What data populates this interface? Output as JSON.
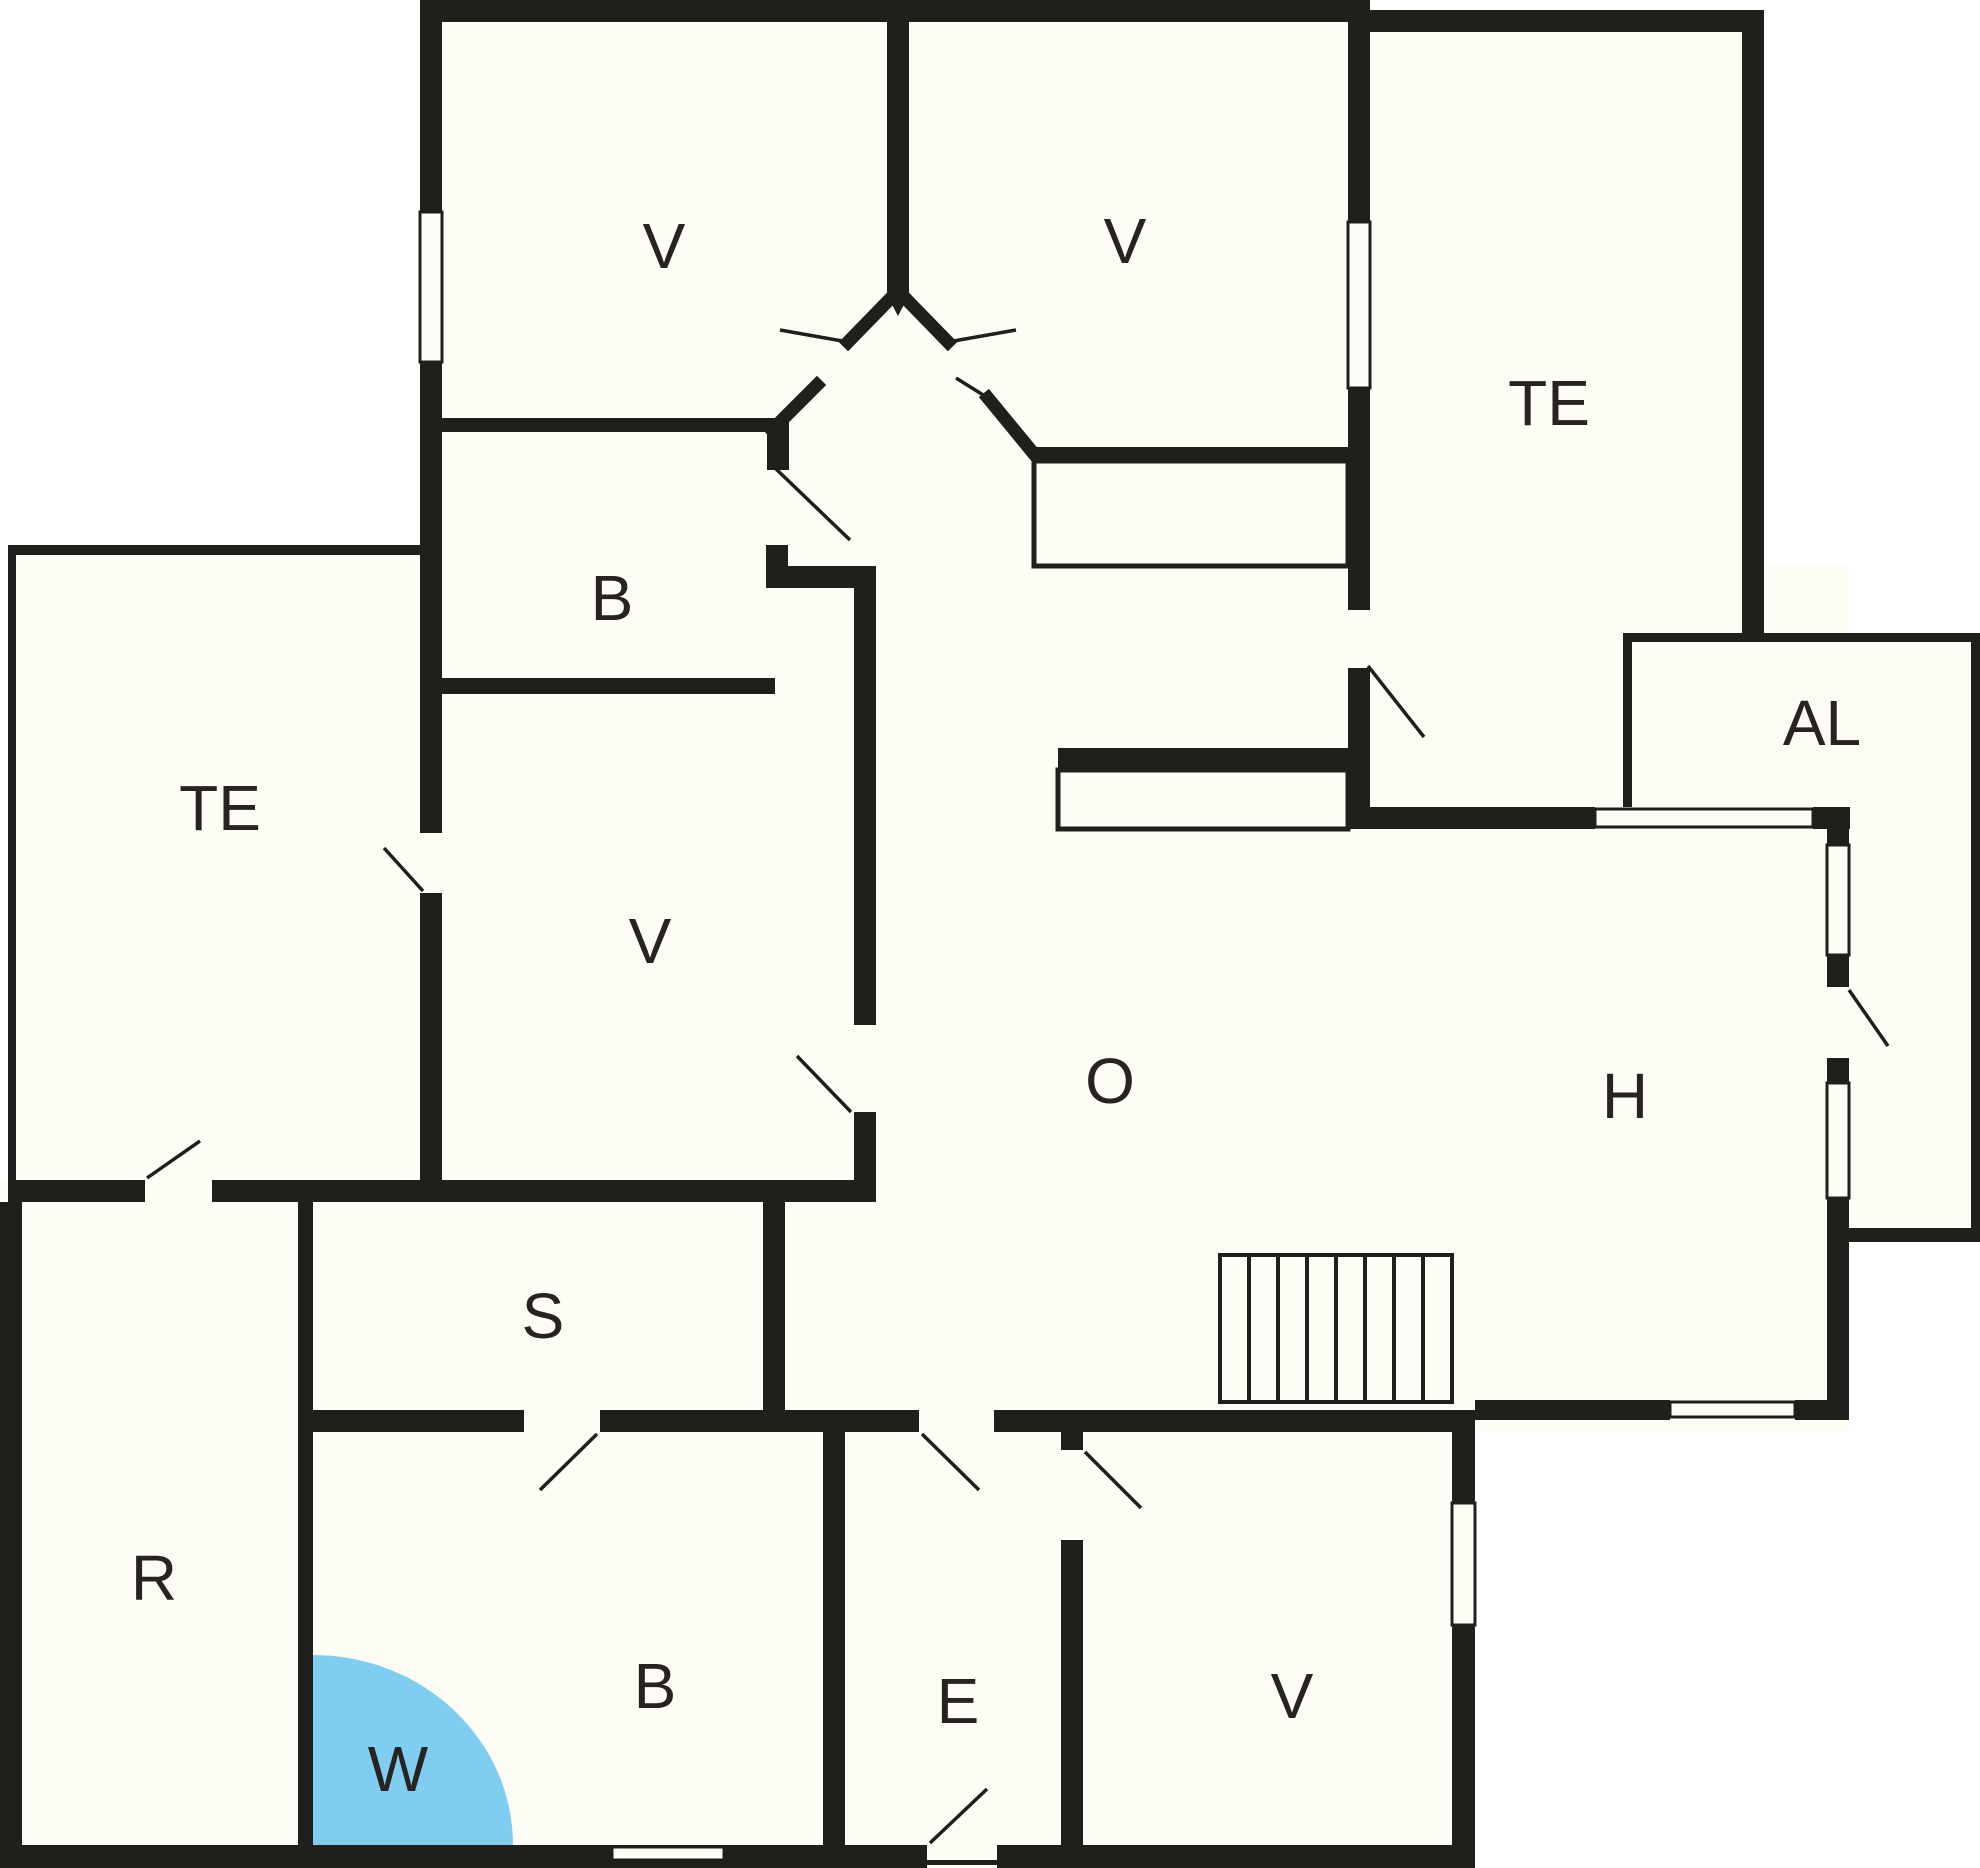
{
  "title": "Holiday home floor plan",
  "colors": {
    "wall": "#211f1c",
    "floor": "#fdfdf6",
    "outside": "#ffffff",
    "bath_accent": "#7fcef2",
    "label": "#262320"
  },
  "rooms": [
    {
      "id": "v-top-left",
      "label": "V"
    },
    {
      "id": "v-top-right",
      "label": "V"
    },
    {
      "id": "te-top-right",
      "label": "TE"
    },
    {
      "id": "b-upper",
      "label": "B"
    },
    {
      "id": "te-left",
      "label": "TE"
    },
    {
      "id": "v-middle",
      "label": "V"
    },
    {
      "id": "al",
      "label": "AL"
    },
    {
      "id": "o-living",
      "label": "O"
    },
    {
      "id": "h-hall",
      "label": "H"
    },
    {
      "id": "s-room",
      "label": "S"
    },
    {
      "id": "r-room",
      "label": "R"
    },
    {
      "id": "b-lower",
      "label": "B"
    },
    {
      "id": "w-bath",
      "label": "W"
    },
    {
      "id": "e-entry",
      "label": "E"
    },
    {
      "id": "v-bottom",
      "label": "V"
    }
  ]
}
